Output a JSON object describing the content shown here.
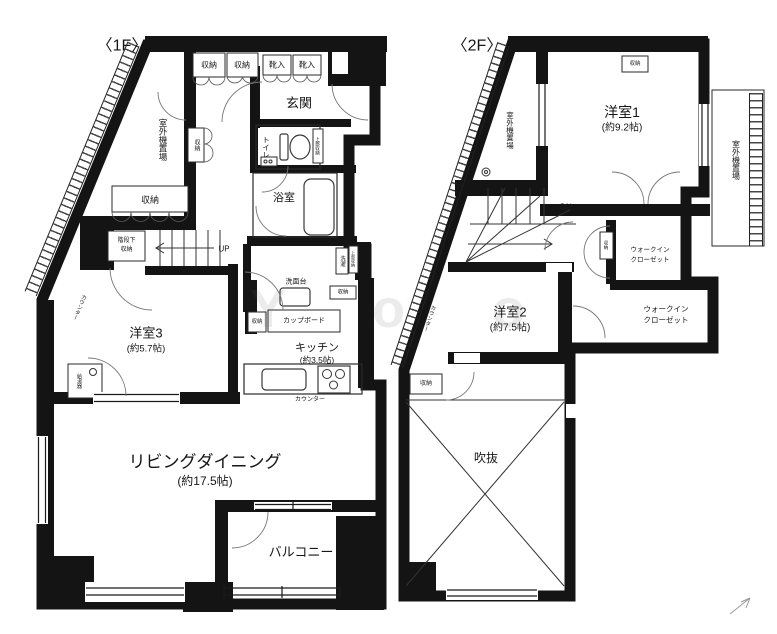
{
  "floor1": {
    "title": "〈1F〉",
    "closet_a": "収納",
    "closet_b": "収納",
    "shoe_a": "靴入",
    "shoe_b": "靴入",
    "entrance": "玄関",
    "outdoor_unit": "室外機置場",
    "toilet": "トイレ",
    "toilet_upper_storage": "上部収納",
    "hall_storage": "収納",
    "bath": "浴室",
    "storage_long": "収納",
    "under_stairs_1": "階段下",
    "under_stairs_2": "収納",
    "stairs_up": "UP",
    "room3": "洋室3",
    "room3_size": "(約5.7帖)",
    "counter_side": "カウンター",
    "water_heater": "給湯器",
    "washstand": "洗面台",
    "laundry": "洗濯",
    "laundry_upper_storage": "上部収納",
    "storage_small_a": "収納",
    "storage_small_b": "収納",
    "cupboard": "カップボード",
    "kitchen": "キッチン",
    "kitchen_size": "(約3.5帖)",
    "counter": "カウンター",
    "living": "リビングダイニング",
    "living_size": "(約17.5帖)",
    "balcony": "バルコニー"
  },
  "floor2": {
    "title": "〈2F〉",
    "outdoor_unit_left": "室外機置場",
    "outdoor_unit_right": "室外機置場",
    "top_storage": "収納",
    "room1": "洋室1",
    "room1_size": "(約9.2帖)",
    "stairs_dn": "DN",
    "stair_storage": "収納",
    "wic1_line1": "ウォークイン",
    "wic1_line2": "クローゼット",
    "wic2_line1": "ウォークイン",
    "wic2_line2": "クローゼット",
    "room2": "洋室2",
    "room2_size": "(約7.5帖)",
    "counter_side": "カウンター",
    "storage_bottom": "収納",
    "void": "吹抜"
  },
  "watermark": "Y o o"
}
